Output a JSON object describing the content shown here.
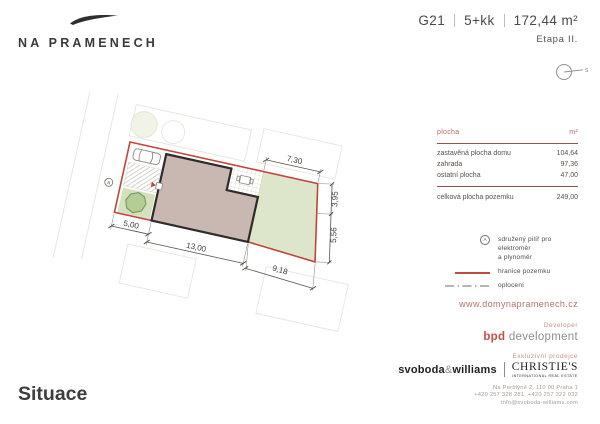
{
  "brand": {
    "name": "NA PRAMENECH"
  },
  "header": {
    "unit_code": "G21",
    "layout": "5+kk",
    "area": "172,44 m²",
    "stage": "Etapa II.",
    "compass_label": "S"
  },
  "plan": {
    "marker_label": "A",
    "dims": {
      "strip_width": "5,00",
      "house_width": "13,00",
      "garden_bottom": "9,18",
      "garden_top": "7,30",
      "right_upper": "3,95",
      "right_lower": "5,56"
    }
  },
  "table": {
    "header": {
      "label": "plocha",
      "unit": "m²"
    },
    "rows": [
      {
        "label": "zastavěná plocha domu",
        "value": "104,64"
      },
      {
        "label": "zahrada",
        "value": "97,36"
      },
      {
        "label": "ostatní plocha",
        "value": "47,00"
      }
    ],
    "total": {
      "label": "celková plocha pozemku",
      "value": "249,00"
    }
  },
  "legend": {
    "items": [
      {
        "lines": [
          "sdružený pilíř pro elektroměr",
          "a plynoměr"
        ]
      },
      {
        "lines": [
          "hranice pozemku"
        ]
      },
      {
        "lines": [
          "oplocení"
        ]
      }
    ]
  },
  "website": "www.domynapramenech.cz",
  "footer": {
    "developer_label": "Developer",
    "developer_accent": "bpd",
    "developer_rest": " development",
    "seller_label": "Exkluzivní prodejce",
    "agency1_left": "svoboda",
    "agency1_amp": "&",
    "agency1_right": "williams",
    "agency2_name": "CHRISTIE'S",
    "agency2_sub": "INTERNATIONAL REAL ESTATE",
    "address_lines": [
      "Na Perštýně 2, 110 00 Praha 1",
      "+420 257 328 281, +420 257 322 032",
      "info@svoboda-williams.com"
    ]
  },
  "page_title": "Situace",
  "colors": {
    "boundary_red": "#c0463c",
    "house_fill": "#c9b8b2",
    "garden_green": "#dde6ca",
    "accent_red": "#b3726a"
  }
}
